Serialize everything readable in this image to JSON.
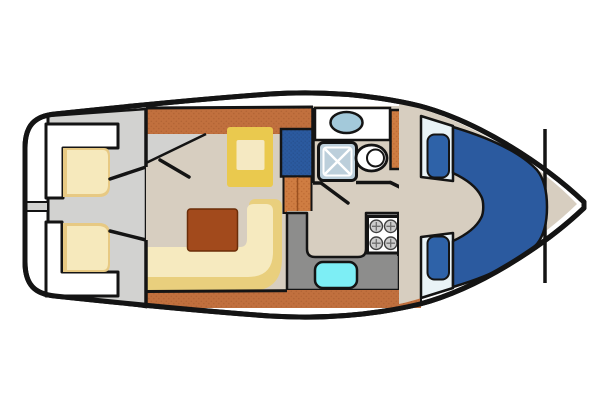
{
  "plan": {
    "kind": "motor-yacht-deck-plan",
    "orientation": "bow-right",
    "rooms": [
      "swim-platform",
      "aft-deck",
      "salon",
      "companionway-steps",
      "bathroom",
      "galley",
      "corridor",
      "bow-cabin",
      "anchor-locker"
    ],
    "fixtures": [
      "aft-bench-seats",
      "aft-seat-cushions",
      "dinette-seat",
      "dinette-table",
      "salon-sofa",
      "blue-cabinet",
      "steps",
      "galley-counter",
      "stove",
      "galley-sink",
      "bathroom-counter",
      "bathroom-sink",
      "shower",
      "toilet",
      "wardrobe-cabinet",
      "v-berth-bed",
      "berth-pillows"
    ]
  },
  "colors": {
    "background": "#ffffff",
    "outline": "#141414",
    "hull_white": "#ffffff",
    "deck_gray": "#d2d2d0",
    "wood_floor": "#c1703e",
    "wood_floor_dark": "#a3582b",
    "bright_wood": "#cf7d42",
    "bright_wood_dark": "#ad5c28",
    "interior_beige": "#d7cec0",
    "counter_gray": "#8d8d8c",
    "cushion_yellow": "#e7c983",
    "cushion_cream": "#f6e9bc",
    "seat_yellow": "#eac94e",
    "seat_cream": "#f5e9c2",
    "sofa_yellow": "#e9cf7d",
    "sofa_cream": "#f6eabf",
    "table_brown": "#a24a1c",
    "table_border": "#6b2d08",
    "accent_blue": "#2b5a9f",
    "accent_blue_dark": "#1f4379",
    "bed_blue": "#2b5a9f",
    "pillow_blue": "#2e62a8",
    "sheet_white": "#e9f3f7",
    "galley_sink_cyan": "#7deef5",
    "bath_sink_blue": "#a3c9da",
    "shower_blue_gray": "#bccfdb",
    "fixture_white": "#ffffff",
    "burner_gray": "#cdcdcd",
    "burner_ring": "#3f3f3f",
    "burner_cross": "#6f6f6f",
    "step_divider": "#9a501f"
  }
}
